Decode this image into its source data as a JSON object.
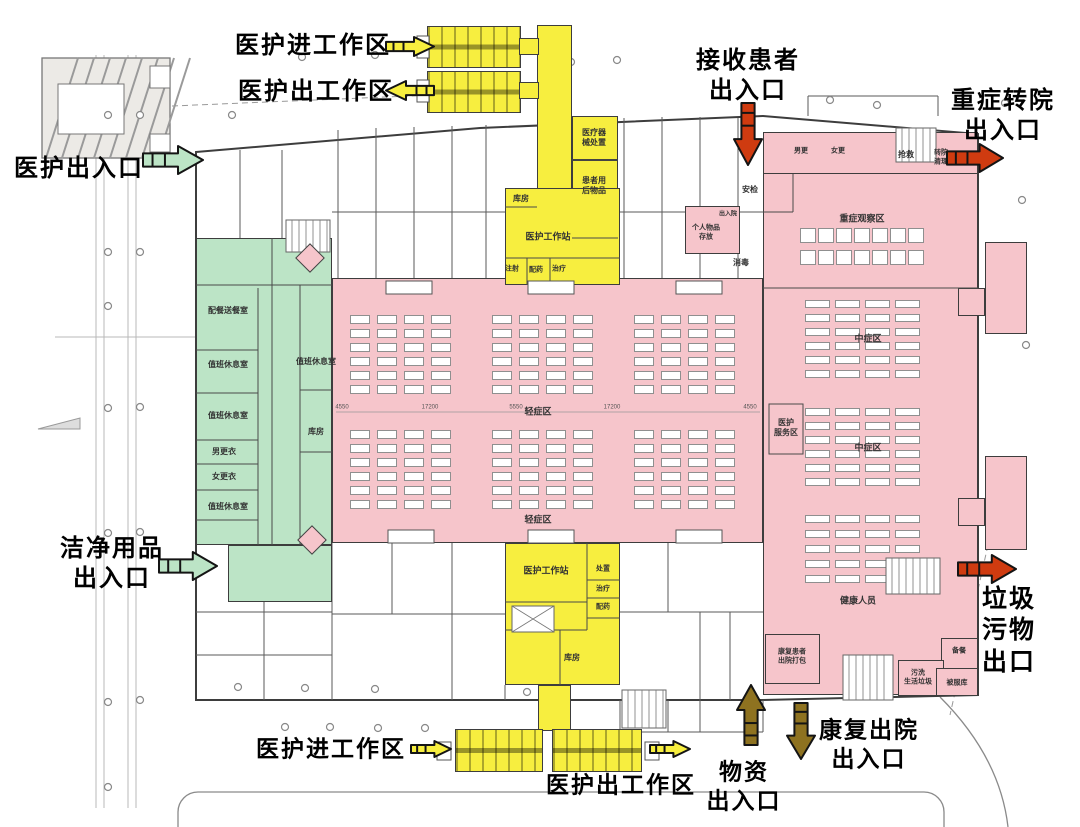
{
  "colors": {
    "pink": "#f6c5cb",
    "green": "#bce4c6",
    "yellow": "#f7ee3f",
    "red": "#cf3b10",
    "brown": "#8e7220",
    "wall": "#3d3d3d"
  },
  "zones": [
    {
      "name": "zone-staff-green",
      "x": 196,
      "y": 238,
      "w": 136,
      "h": 307,
      "fill": "green"
    },
    {
      "name": "zone-clean-supply-green",
      "x": 228,
      "y": 545,
      "w": 104,
      "h": 57,
      "fill": "green"
    },
    {
      "name": "zone-ward-mild",
      "x": 332,
      "y": 278,
      "w": 431,
      "h": 265,
      "fill": "pink"
    },
    {
      "name": "zone-ward-right",
      "x": 763,
      "y": 172,
      "w": 215,
      "h": 523,
      "fill": "pink"
    },
    {
      "name": "zone-ward-topstrip",
      "x": 763,
      "y": 132,
      "w": 215,
      "h": 42,
      "fill": "pink"
    },
    {
      "name": "zone-anteroom",
      "x": 685,
      "y": 206,
      "w": 55,
      "h": 48,
      "fill": "pink"
    },
    {
      "name": "zone-discharge-pack",
      "x": 765,
      "y": 634,
      "w": 55,
      "h": 50,
      "fill": "pink"
    },
    {
      "name": "zone-prep-room",
      "x": 941,
      "y": 638,
      "w": 37,
      "h": 40,
      "fill": "pink"
    },
    {
      "name": "zone-waste-wash",
      "x": 898,
      "y": 660,
      "w": 46,
      "h": 36,
      "fill": "pink"
    },
    {
      "name": "zone-linen",
      "x": 936,
      "y": 668,
      "w": 42,
      "h": 28,
      "fill": "pink"
    },
    {
      "name": "zone-toilet-upper",
      "x": 985,
      "y": 242,
      "w": 42,
      "h": 92,
      "fill": "pink"
    },
    {
      "name": "zone-toilet-lower",
      "x": 985,
      "y": 456,
      "w": 42,
      "h": 94,
      "fill": "pink"
    },
    {
      "name": "zone-toilet-link-upper",
      "x": 958,
      "y": 288,
      "w": 27,
      "h": 28,
      "fill": "pink"
    },
    {
      "name": "zone-toilet-link-lower",
      "x": 958,
      "y": 498,
      "w": 27,
      "h": 28,
      "fill": "pink"
    },
    {
      "name": "zone-corridor-top",
      "x": 537,
      "y": 25,
      "w": 35,
      "h": 166,
      "fill": "yellow"
    },
    {
      "name": "zone-module-top-a",
      "x": 427,
      "y": 26,
      "w": 94,
      "h": 42,
      "fill": "yellow",
      "module": true
    },
    {
      "name": "zone-module-top-b",
      "x": 427,
      "y": 71,
      "w": 94,
      "h": 42,
      "fill": "yellow",
      "module": true
    },
    {
      "name": "zone-link-top-a",
      "x": 519,
      "y": 38,
      "w": 20,
      "h": 17,
      "fill": "yellow"
    },
    {
      "name": "zone-link-top-b",
      "x": 519,
      "y": 82,
      "w": 20,
      "h": 17,
      "fill": "yellow"
    },
    {
      "name": "zone-equip-disposal",
      "x": 572,
      "y": 116,
      "w": 46,
      "h": 44,
      "fill": "yellow"
    },
    {
      "name": "zone-used-items",
      "x": 572,
      "y": 160,
      "w": 46,
      "h": 78,
      "fill": "yellow"
    },
    {
      "name": "zone-workstation-top",
      "x": 505,
      "y": 188,
      "w": 115,
      "h": 97,
      "fill": "yellow"
    },
    {
      "name": "zone-workstation-bottom",
      "x": 505,
      "y": 543,
      "w": 115,
      "h": 142,
      "fill": "yellow"
    },
    {
      "name": "zone-corridor-bottom",
      "x": 538,
      "y": 685,
      "w": 33,
      "h": 46,
      "fill": "yellow"
    },
    {
      "name": "zone-module-bot-a",
      "x": 455,
      "y": 729,
      "w": 88,
      "h": 43,
      "fill": "yellow",
      "module": true
    },
    {
      "name": "zone-module-bot-b",
      "x": 552,
      "y": 729,
      "w": 90,
      "h": 43,
      "fill": "yellow",
      "module": true
    }
  ],
  "rooms": [
    {
      "label": "配餐送餐室",
      "x": 228,
      "y": 311,
      "fs": 8
    },
    {
      "label": "值班休息室",
      "x": 228,
      "y": 365,
      "fs": 8
    },
    {
      "label": "值班休息室",
      "x": 228,
      "y": 416,
      "fs": 8
    },
    {
      "label": "男更衣",
      "x": 224,
      "y": 452,
      "fs": 8
    },
    {
      "label": "女更衣",
      "x": 224,
      "y": 477,
      "fs": 8
    },
    {
      "label": "值班休息室",
      "x": 228,
      "y": 507,
      "fs": 8
    },
    {
      "label": "值班休息室",
      "x": 316,
      "y": 362,
      "fs": 8
    },
    {
      "label": "库房",
      "x": 316,
      "y": 432,
      "fs": 8
    },
    {
      "label": "库房",
      "x": 521,
      "y": 199,
      "fs": 8
    },
    {
      "label": "医护工作站",
      "x": 548,
      "y": 237,
      "fs": 9
    },
    {
      "label": "注射",
      "x": 512,
      "y": 270,
      "fs": 7
    },
    {
      "label": "配药",
      "x": 536,
      "y": 271,
      "fs": 7
    },
    {
      "label": "治疗",
      "x": 559,
      "y": 270,
      "fs": 7
    },
    {
      "label": "医疗器\n械处置",
      "x": 594,
      "y": 138,
      "fs": 8
    },
    {
      "label": "患者用\n后物品",
      "x": 594,
      "y": 186,
      "fs": 8
    },
    {
      "label": "医护工作站",
      "x": 546,
      "y": 571,
      "fs": 9
    },
    {
      "label": "处置",
      "x": 603,
      "y": 570,
      "fs": 7
    },
    {
      "label": "治疗",
      "x": 603,
      "y": 590,
      "fs": 7
    },
    {
      "label": "配药",
      "x": 603,
      "y": 608,
      "fs": 7
    },
    {
      "label": "库房",
      "x": 572,
      "y": 658,
      "fs": 8
    },
    {
      "label": "轻症区",
      "x": 538,
      "y": 412,
      "fs": 9
    },
    {
      "label": "轻症区",
      "x": 538,
      "y": 520,
      "fs": 9
    },
    {
      "label": "重症观察区",
      "x": 862,
      "y": 219,
      "fs": 9
    },
    {
      "label": "中症区",
      "x": 868,
      "y": 339,
      "fs": 9
    },
    {
      "label": "中症区",
      "x": 868,
      "y": 448,
      "fs": 9
    },
    {
      "label": "健康人员",
      "x": 858,
      "y": 601,
      "fs": 9
    },
    {
      "label": "医护\n服务区",
      "x": 786,
      "y": 428,
      "fs": 8
    },
    {
      "label": "安检",
      "x": 750,
      "y": 190,
      "fs": 8
    },
    {
      "label": "消毒",
      "x": 741,
      "y": 263,
      "fs": 8
    },
    {
      "label": "男更",
      "x": 801,
      "y": 152,
      "fs": 7
    },
    {
      "label": "女更",
      "x": 838,
      "y": 152,
      "fs": 7
    },
    {
      "label": "抢救",
      "x": 906,
      "y": 155,
      "fs": 8
    },
    {
      "label": "转院\n清理",
      "x": 941,
      "y": 158,
      "fs": 7
    },
    {
      "label": "出入院",
      "x": 728,
      "y": 215,
      "fs": 6
    },
    {
      "label": "个人物品\n存放",
      "x": 706,
      "y": 233,
      "fs": 7
    },
    {
      "label": "康复患者\n出院打包",
      "x": 792,
      "y": 657,
      "fs": 7
    },
    {
      "label": "备餐",
      "x": 959,
      "y": 652,
      "fs": 7
    },
    {
      "label": "污洗\n生活垃圾",
      "x": 918,
      "y": 678,
      "fs": 7
    },
    {
      "label": "被服库",
      "x": 957,
      "y": 684,
      "fs": 7
    }
  ],
  "bed_grids": [
    {
      "x": 350,
      "y": 315,
      "rows": 6,
      "cols": 4,
      "cw": 20,
      "ch": 9,
      "gx": 7,
      "gy": 5
    },
    {
      "x": 492,
      "y": 315,
      "rows": 6,
      "cols": 4,
      "cw": 20,
      "ch": 9,
      "gx": 7,
      "gy": 5
    },
    {
      "x": 634,
      "y": 315,
      "rows": 6,
      "cols": 4,
      "cw": 20,
      "ch": 9,
      "gx": 7,
      "gy": 5
    },
    {
      "x": 350,
      "y": 430,
      "rows": 6,
      "cols": 4,
      "cw": 20,
      "ch": 9,
      "gx": 7,
      "gy": 5
    },
    {
      "x": 492,
      "y": 430,
      "rows": 6,
      "cols": 4,
      "cw": 20,
      "ch": 9,
      "gx": 7,
      "gy": 5
    },
    {
      "x": 634,
      "y": 430,
      "rows": 6,
      "cols": 4,
      "cw": 20,
      "ch": 9,
      "gx": 7,
      "gy": 5
    },
    {
      "x": 800,
      "y": 228,
      "rows": 2,
      "cols": 7,
      "cw": 16,
      "ch": 15,
      "gx": 2,
      "gy": 7
    },
    {
      "x": 805,
      "y": 300,
      "rows": 6,
      "cols": 4,
      "cw": 25,
      "ch": 8,
      "gx": 5,
      "gy": 6
    },
    {
      "x": 805,
      "y": 408,
      "rows": 6,
      "cols": 4,
      "cw": 25,
      "ch": 8,
      "gx": 5,
      "gy": 6
    },
    {
      "x": 805,
      "y": 515,
      "rows": 5,
      "cols": 4,
      "cw": 25,
      "ch": 8,
      "gx": 5,
      "gy": 7
    }
  ],
  "dimension_labels": {
    "y": 411,
    "xs": [
      342,
      430,
      516,
      612,
      750
    ],
    "values": [
      "4550",
      "17200",
      "5550",
      "17200",
      "4550"
    ]
  },
  "entrances": [
    {
      "name": "staff-enter-top",
      "label": "医护进工作区",
      "cx": 313,
      "cy": 46,
      "fs": 24,
      "dir": "right",
      "color": "yellow",
      "ax": 385,
      "ay": 36,
      "len": 50,
      "g": 21
    },
    {
      "name": "staff-exit-top",
      "label": "医护出工作区",
      "cx": 316,
      "cy": 92,
      "fs": 24,
      "dir": "left",
      "color": "yellow",
      "ax": 385,
      "ay": 80,
      "len": 50,
      "g": 21
    },
    {
      "name": "receive-patients",
      "label": "接收患者\n出入口",
      "cx": 748,
      "cy": 76,
      "fs": 24,
      "dir": "down",
      "color": "red",
      "ax": 733,
      "ay": 102,
      "len": 64,
      "g": 30
    },
    {
      "name": "severe-transfer",
      "label": "重症转院\n出入口",
      "cx": 1003,
      "cy": 116,
      "fs": 24,
      "dir": "right",
      "color": "red",
      "ax": 946,
      "ay": 143,
      "len": 58,
      "g": 30
    },
    {
      "name": "staff-exit-left",
      "label": "医护出入口",
      "cx": 79,
      "cy": 169,
      "fs": 24,
      "dir": "right",
      "color": "green",
      "ax": 142,
      "ay": 145,
      "len": 62,
      "g": 30
    },
    {
      "name": "clean-supplies",
      "label": "洁净用品\n出入口",
      "cx": 112,
      "cy": 564,
      "fs": 24,
      "dir": "right",
      "color": "green",
      "ax": 158,
      "ay": 551,
      "len": 60,
      "g": 30
    },
    {
      "name": "staff-enter-bottom",
      "label": "医护进工作区",
      "cx": 331,
      "cy": 749,
      "fs": 23,
      "dir": "right",
      "color": "yellow",
      "ax": 410,
      "ay": 740,
      "len": 42,
      "g": 18
    },
    {
      "name": "staff-exit-bottom",
      "label": "医护出工作区",
      "cx": 621,
      "cy": 785,
      "fs": 23,
      "dir": "right",
      "color": "yellow",
      "ax": 649,
      "ay": 740,
      "len": 42,
      "g": 18
    },
    {
      "name": "supplies",
      "label": "物资\n出入口",
      "cx": 744,
      "cy": 786,
      "fs": 23,
      "dir": "up",
      "color": "brown",
      "ax": 736,
      "ay": 684,
      "len": 62,
      "g": 30
    },
    {
      "name": "recovery-discharge",
      "label": "康复出院\n出入口",
      "cx": 869,
      "cy": 744,
      "fs": 23,
      "dir": "down",
      "color": "brown",
      "ax": 786,
      "ay": 702,
      "len": 58,
      "g": 30
    },
    {
      "name": "waste",
      "label": "垃圾\n污物\n出口",
      "cx": 1009,
      "cy": 631,
      "fs": 25,
      "dir": "right",
      "color": "red",
      "ax": 957,
      "ay": 554,
      "len": 60,
      "g": 30
    }
  ]
}
